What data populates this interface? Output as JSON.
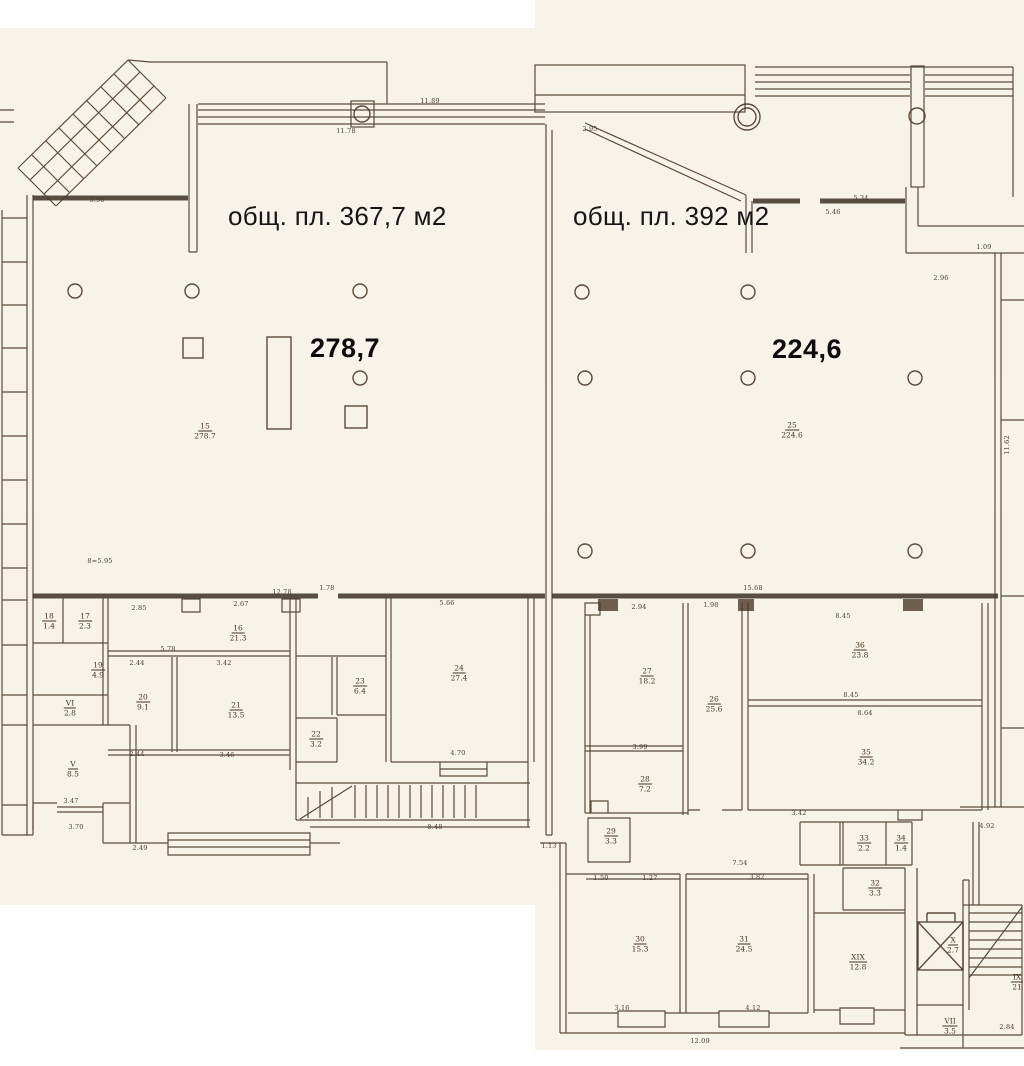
{
  "labels": {
    "left_unit_area": "общ. пл. 367,7 м2",
    "right_unit_area": "общ. пл. 392 м2",
    "left_hall_value": "278,7",
    "right_hall_value": "224,6"
  },
  "colors": {
    "paper": "#f8f3e9",
    "ink": "#4a3828",
    "overlay_text": "#111111"
  },
  "rooms": [
    {
      "num": "15",
      "area": "278.7",
      "x": 205,
      "y": 431
    },
    {
      "num": "25",
      "area": "224.6",
      "x": 792,
      "y": 430
    },
    {
      "num": "16",
      "area": "21.3",
      "x": 238,
      "y": 633
    },
    {
      "num": "18",
      "area": "1.4",
      "x": 49,
      "y": 621
    },
    {
      "num": "17",
      "area": "2.3",
      "x": 85,
      "y": 621
    },
    {
      "num": "19",
      "area": "4.9",
      "x": 98,
      "y": 670
    },
    {
      "num": "VI",
      "area": "2.8",
      "x": 70,
      "y": 708
    },
    {
      "num": "V",
      "area": "8.5",
      "x": 73,
      "y": 769
    },
    {
      "num": "20",
      "area": "9.1",
      "x": 143,
      "y": 702
    },
    {
      "num": "21",
      "area": "13.5",
      "x": 236,
      "y": 710
    },
    {
      "num": "22",
      "area": "3.2",
      "x": 316,
      "y": 739
    },
    {
      "num": "23",
      "area": "6.4",
      "x": 360,
      "y": 686
    },
    {
      "num": "24",
      "area": "27.4",
      "x": 459,
      "y": 673
    },
    {
      "num": "27",
      "area": "18.2",
      "x": 647,
      "y": 676
    },
    {
      "num": "26",
      "area": "25.6",
      "x": 714,
      "y": 704
    },
    {
      "num": "28",
      "area": "7.2",
      "x": 645,
      "y": 784
    },
    {
      "num": "29",
      "area": "3.3",
      "x": 611,
      "y": 836
    },
    {
      "num": "30",
      "area": "15.3",
      "x": 640,
      "y": 944
    },
    {
      "num": "31",
      "area": "24.5",
      "x": 744,
      "y": 944
    },
    {
      "num": "36",
      "area": "23.8",
      "x": 860,
      "y": 650
    },
    {
      "num": "35",
      "area": "34.2",
      "x": 866,
      "y": 757
    },
    {
      "num": "33",
      "area": "2.2",
      "x": 864,
      "y": 843
    },
    {
      "num": "34",
      "area": "1.4",
      "x": 901,
      "y": 843
    },
    {
      "num": "32",
      "area": "3.3",
      "x": 875,
      "y": 888
    },
    {
      "num": "XIX",
      "area": "12.8",
      "x": 858,
      "y": 962
    },
    {
      "num": "X",
      "area": "2.7",
      "x": 953,
      "y": 945
    },
    {
      "num": "VII",
      "area": "3.5",
      "x": 950,
      "y": 1026
    },
    {
      "num": "IX",
      "area": "21",
      "x": 1017,
      "y": 982
    }
  ],
  "dims": [
    {
      "t": "11.78",
      "x": 346,
      "y": 131
    },
    {
      "t": "11.89",
      "x": 430,
      "y": 101
    },
    {
      "t": "5.90",
      "x": 97,
      "y": 200
    },
    {
      "t": "2.95",
      "x": 590,
      "y": 129
    },
    {
      "t": "5.34",
      "x": 861,
      "y": 198
    },
    {
      "t": "5.46",
      "x": 833,
      "y": 212
    },
    {
      "t": "1.09",
      "x": 984,
      "y": 247
    },
    {
      "t": "2.96",
      "x": 941,
      "y": 278
    },
    {
      "t": "2.85",
      "x": 139,
      "y": 608
    },
    {
      "t": "2.67",
      "x": 241,
      "y": 604
    },
    {
      "t": "12.78",
      "x": 282,
      "y": 592
    },
    {
      "t": "1.78",
      "x": 327,
      "y": 588
    },
    {
      "t": "5.66",
      "x": 447,
      "y": 603
    },
    {
      "t": "5.78",
      "x": 168,
      "y": 649
    },
    {
      "t": "2.44",
      "x": 137,
      "y": 663
    },
    {
      "t": "3.42",
      "x": 224,
      "y": 663
    },
    {
      "t": "2.44",
      "x": 137,
      "y": 754
    },
    {
      "t": "3.46",
      "x": 227,
      "y": 755
    },
    {
      "t": "4.70",
      "x": 458,
      "y": 753
    },
    {
      "t": "3.99",
      "x": 640,
      "y": 747
    },
    {
      "t": "2.94",
      "x": 639,
      "y": 607
    },
    {
      "t": "1.98",
      "x": 711,
      "y": 605
    },
    {
      "t": "15.68",
      "x": 753,
      "y": 588
    },
    {
      "t": "8.45",
      "x": 843,
      "y": 616
    },
    {
      "t": "8.45",
      "x": 851,
      "y": 695
    },
    {
      "t": "8.64",
      "x": 865,
      "y": 713
    },
    {
      "t": "3.42",
      "x": 799,
      "y": 813
    },
    {
      "t": "4.92",
      "x": 987,
      "y": 826
    },
    {
      "t": "3.47",
      "x": 71,
      "y": 801
    },
    {
      "t": "3.70",
      "x": 76,
      "y": 827
    },
    {
      "t": "2.49",
      "x": 140,
      "y": 848
    },
    {
      "t": "1.13",
      "x": 549,
      "y": 846
    },
    {
      "t": "7.54",
      "x": 740,
      "y": 863
    },
    {
      "t": "3.82",
      "x": 757,
      "y": 877
    },
    {
      "t": "1.27",
      "x": 650,
      "y": 878
    },
    {
      "t": "1.50",
      "x": 601,
      "y": 878
    },
    {
      "t": "3.16",
      "x": 622,
      "y": 1008
    },
    {
      "t": "4.12",
      "x": 753,
      "y": 1008
    },
    {
      "t": "12.09",
      "x": 700,
      "y": 1041
    },
    {
      "t": "8.48",
      "x": 435,
      "y": 827
    },
    {
      "t": "2.84",
      "x": 1007,
      "y": 1027
    },
    {
      "t": "8=5.95",
      "x": 100,
      "y": 561
    },
    {
      "t": "11.62",
      "x": 1007,
      "y": 445,
      "v": true
    }
  ]
}
